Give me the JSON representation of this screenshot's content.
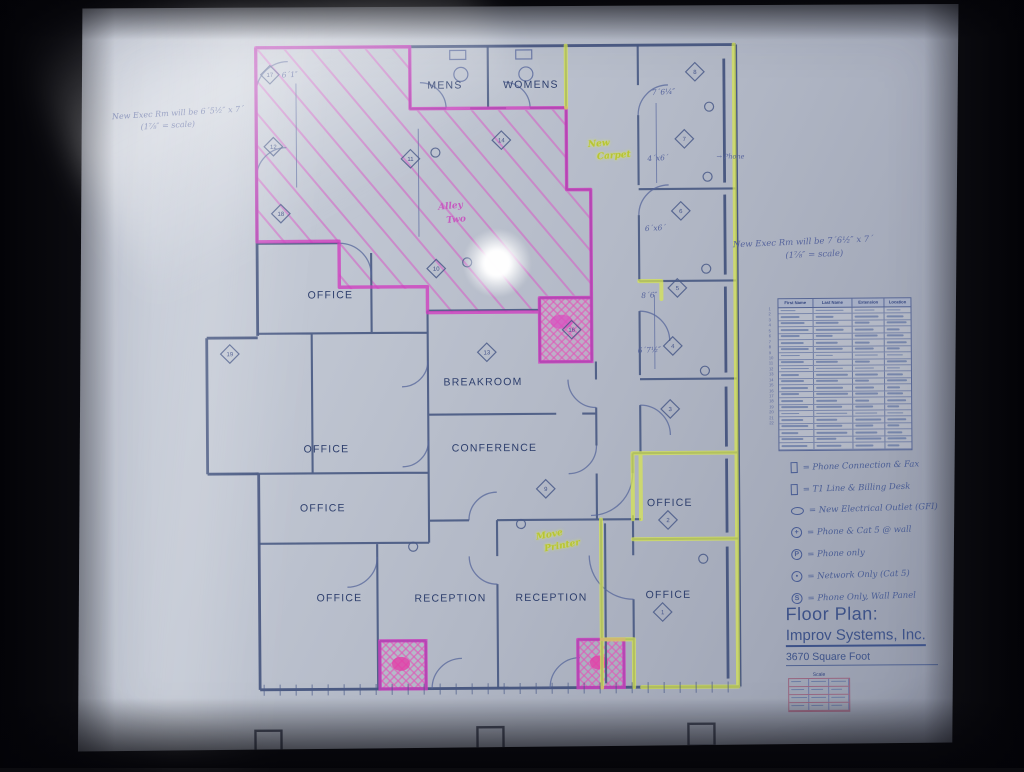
{
  "plan": {
    "rooms": {
      "mens": "MENS",
      "womens": "WOMENS",
      "office_nw": "OFFICE",
      "breakroom": "BREAKROOM",
      "conference": "CONFERENCE",
      "office_w1": "OFFICE",
      "office_w2": "OFFICE",
      "office_sw": "OFFICE",
      "reception_1": "RECEPTION",
      "reception_2": "RECEPTION",
      "office_e1": "OFFICE",
      "office_e2": "OFFICE"
    },
    "markers": [
      "1",
      "2",
      "3",
      "4",
      "5",
      "6",
      "7",
      "8",
      "9",
      "10",
      "11",
      "12",
      "13",
      "14",
      "16",
      "17",
      "18",
      "19"
    ],
    "dims": [
      "7´6¼″",
      "4´x6´",
      "6´x6´",
      "8´6″",
      "6´7½″",
      "6´1″"
    ],
    "notes": {
      "note_nw_1": "New Exec Rm will be 6´5½″ x 7´",
      "note_nw_2": "(1⅞″ = scale)",
      "note_e_1": "New Exec Rm will be 7´6½″ x 7´",
      "note_e_2": "(1⅞″ = scale)",
      "phone": "→ Phone",
      "highlight_1a": "New",
      "highlight_1b": "Carpet",
      "highlight_2a": "Move",
      "highlight_2b": "Printer",
      "pink_a": "Alley",
      "pink_b": "Two"
    }
  },
  "directory": {
    "headers": [
      "First Name",
      "Last Name",
      "Extension",
      "Location"
    ],
    "row_count": 22
  },
  "legend": {
    "items": [
      {
        "icon": "rect-symbol",
        "text": "= Phone Connection & Fax"
      },
      {
        "icon": "rect-symbol",
        "text": "= T1 Line & Billing Desk"
      },
      {
        "icon": "ellipse-symbol",
        "text": "= New Electrical Outlet (GFI)"
      },
      {
        "icon": "circle-plus-symbol",
        "text": "= Phone & Cat 5 @ wall"
      },
      {
        "icon": "circle-p-symbol",
        "text": "= Phone only"
      },
      {
        "icon": "circle-dot-symbol",
        "text": "= Network Only (Cat 5)"
      },
      {
        "icon": "circle-s-symbol",
        "text": "= Phone Only, Wall Panel"
      }
    ]
  },
  "title_block": {
    "heading": "Floor Plan:",
    "company": "Improv Systems, Inc.",
    "area": "3670 Square Foot"
  },
  "scale_table": {
    "caption": "Scale",
    "row_count": 4,
    "col_count": 3
  },
  "colors": {
    "wall_blue": "#3f4f7a",
    "magenta_marker": "#cf3fbf",
    "yellow_green_marker": "#d8e650",
    "label_blue": "#2e3f6d",
    "title_blue": "#3d5288"
  }
}
